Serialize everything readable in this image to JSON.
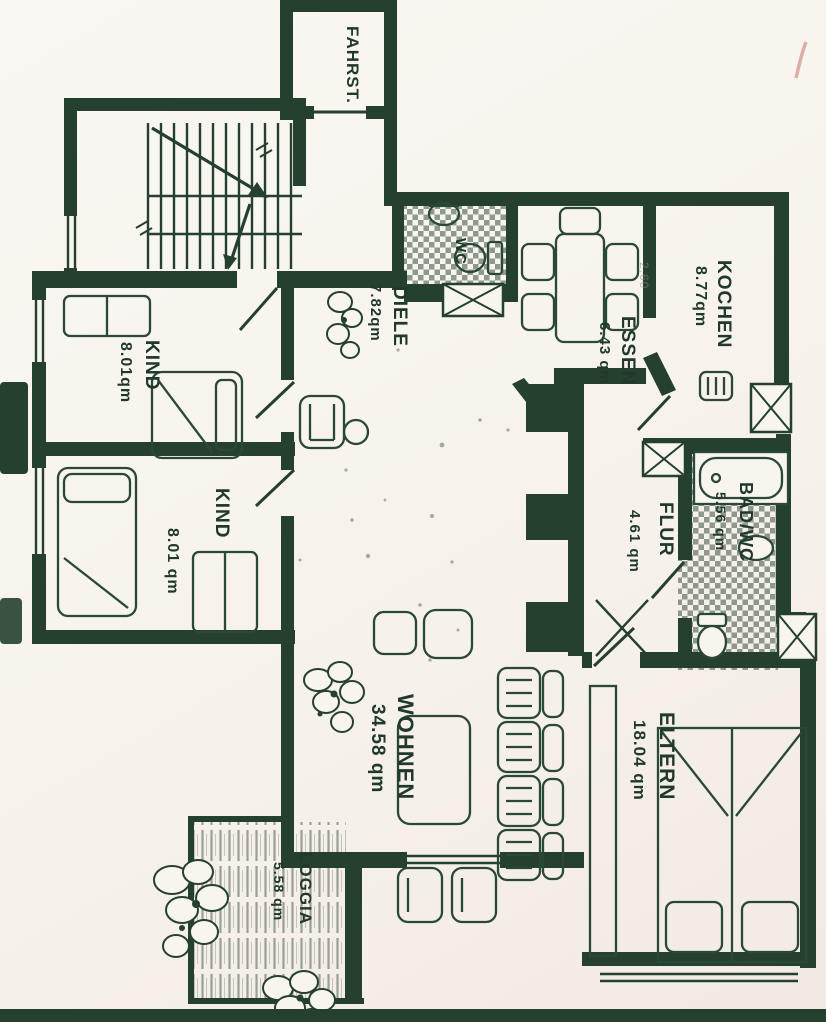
{
  "meta": {
    "title": "Apartment floor plan (scanned)",
    "language": "de"
  },
  "colors": {
    "ink": "#25402f",
    "paper": "#f7f3ec",
    "pen_mark": "#d9a198"
  },
  "rooms": {
    "fahrstuhl": {
      "label": "FAHRST."
    },
    "kind_upper": {
      "label": "KIND",
      "area": "8.01qm"
    },
    "kind_lower": {
      "label": "KIND",
      "area": "8.01 qm"
    },
    "diele": {
      "label": "DIELE",
      "area": "7.82qm"
    },
    "wc": {
      "label": "WC"
    },
    "essen": {
      "label": "ESSEN",
      "area": "6.43 qm"
    },
    "kochen": {
      "label": "KOCHEN",
      "area": "8.77qm"
    },
    "flur": {
      "label": "FLUR",
      "area": "4.61 qm"
    },
    "bad_wc": {
      "label": "BAD/WC",
      "area": "5.56 qm"
    },
    "wohnen": {
      "label": "WOHNEN",
      "area": "34.58 qm"
    },
    "eltern": {
      "label": "ELTERN",
      "area": "18.04 qm"
    },
    "loggia": {
      "label": "LOGGIA",
      "area": "5.58 qm"
    }
  },
  "annotations": {
    "pencil_dimension": "2,60"
  }
}
